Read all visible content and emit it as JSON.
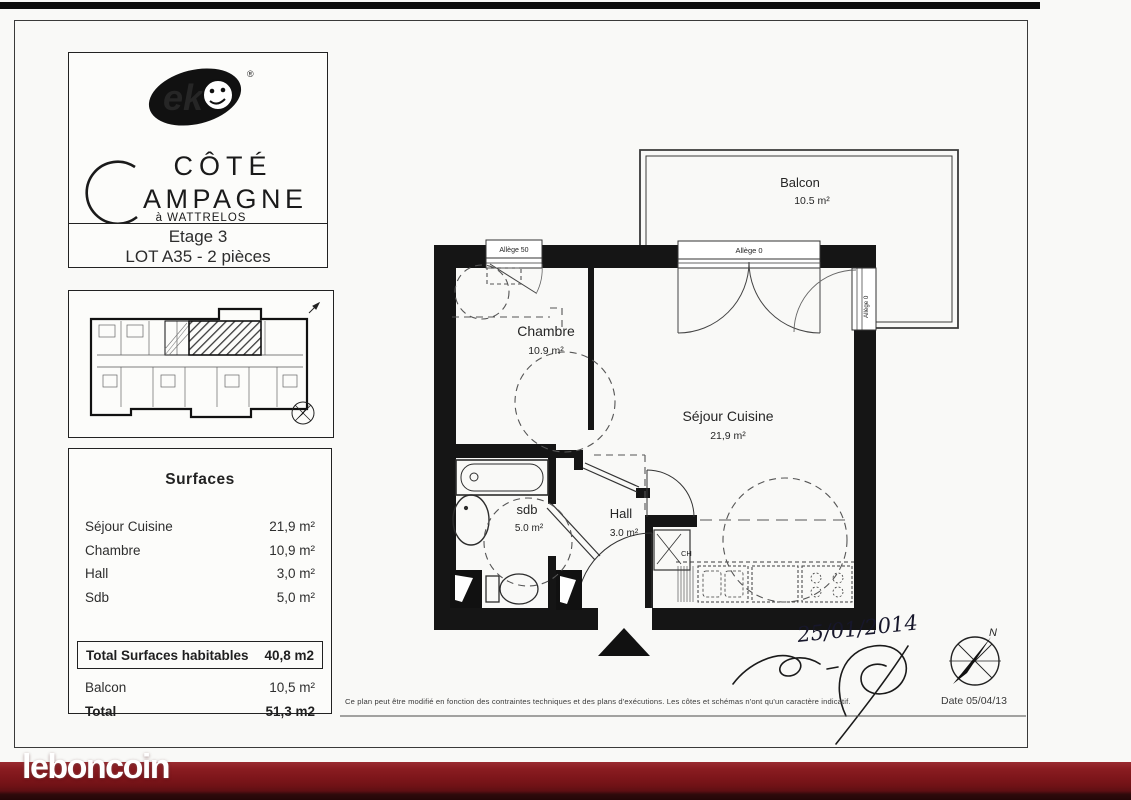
{
  "watermark": {
    "logo_text": "leboncoin"
  },
  "title_block": {
    "brand_visible_letters": "ek",
    "registered_mark": "®",
    "wordmark_line1": "CÔTÉ",
    "wordmark_initial": "C",
    "wordmark_rest": "AMPAGNE",
    "location": "à WATTRELOS",
    "etage": "Etage 3",
    "lot": "LOT A35 - 2 pièces"
  },
  "surfaces": {
    "title": "Surfaces",
    "rows": [
      {
        "label": "Séjour Cuisine",
        "value": "21,9 m²"
      },
      {
        "label": "Chambre",
        "value": "10,9 m²"
      },
      {
        "label": "Hall",
        "value": "3,0 m²"
      },
      {
        "label": "Sdb",
        "value": "5,0 m²"
      }
    ],
    "total_habitable": {
      "label": "Total Surfaces habitables",
      "value": "40,8 m2"
    },
    "balcon": {
      "label": "Balcon",
      "value": "10,5 m²"
    },
    "total": {
      "label": "Total",
      "value": "51,3 m2"
    }
  },
  "floor_plan": {
    "balcon": {
      "name": "Balcon",
      "area": "10.5 m²"
    },
    "chambre": {
      "name": "Chambre",
      "area": "10.9 m²"
    },
    "sejour": {
      "name": "Séjour Cuisine",
      "area": "21,9 m²"
    },
    "sdb": {
      "name": "sdb",
      "area": "5.0 m²"
    },
    "hall": {
      "name": "Hall",
      "area": "3.0 m²"
    },
    "window_labels": {
      "chambre": "Allège 50",
      "balcon_door": "Allège 0",
      "balcon_side": "Allège 0"
    },
    "closet": "CH",
    "compass_north": "N",
    "handwritten_date": "25/01/2014"
  },
  "footer": {
    "disclaimer": "Ce plan peut être modifié en fonction des contraintes techniques et des plans d'exécutions. Les côtes et schémas n'ont qu'un caractère indicatif.",
    "date_label": "Date 05/04/13"
  },
  "colors": {
    "band_red": "#7c161b",
    "paper": "#f9f9f7",
    "ink": "#222222"
  }
}
